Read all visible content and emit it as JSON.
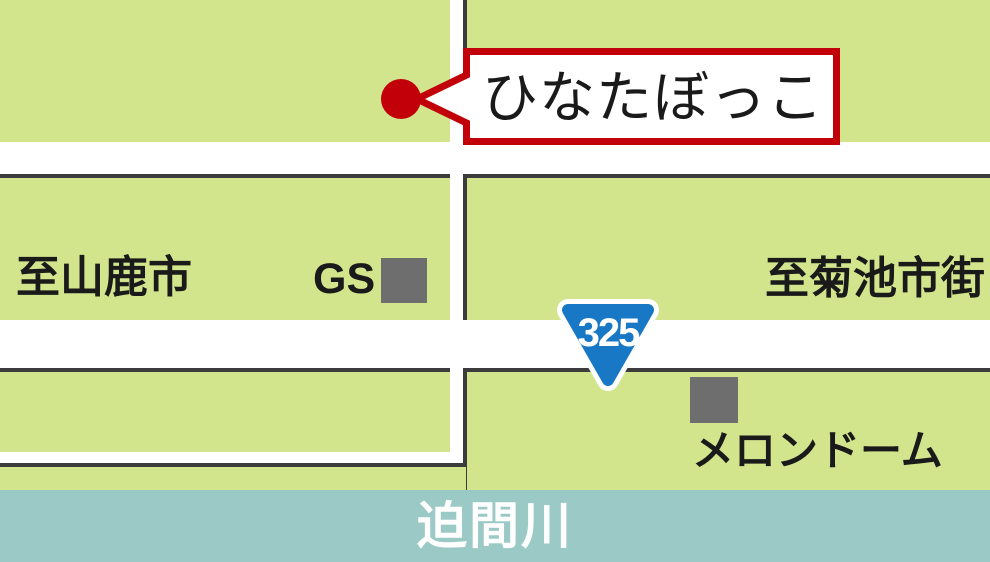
{
  "map": {
    "labels": {
      "destination": "ひなたぼっこ",
      "direction_left": "至山鹿市",
      "gas_station": "GS",
      "direction_right": "至菊池市街",
      "route_number": "325",
      "landmark": "メロンドーム",
      "river": "迫間川"
    },
    "colors": {
      "land": "#d3e58c",
      "road": "#ffffff",
      "outline": "#3c3c3c",
      "building": "#6e6e6e",
      "accent_red": "#c20009",
      "route_blue": "#1878c6",
      "river": "#9bcac6",
      "label_text": "#1a1a1a",
      "river_text": "#ffffff"
    }
  }
}
